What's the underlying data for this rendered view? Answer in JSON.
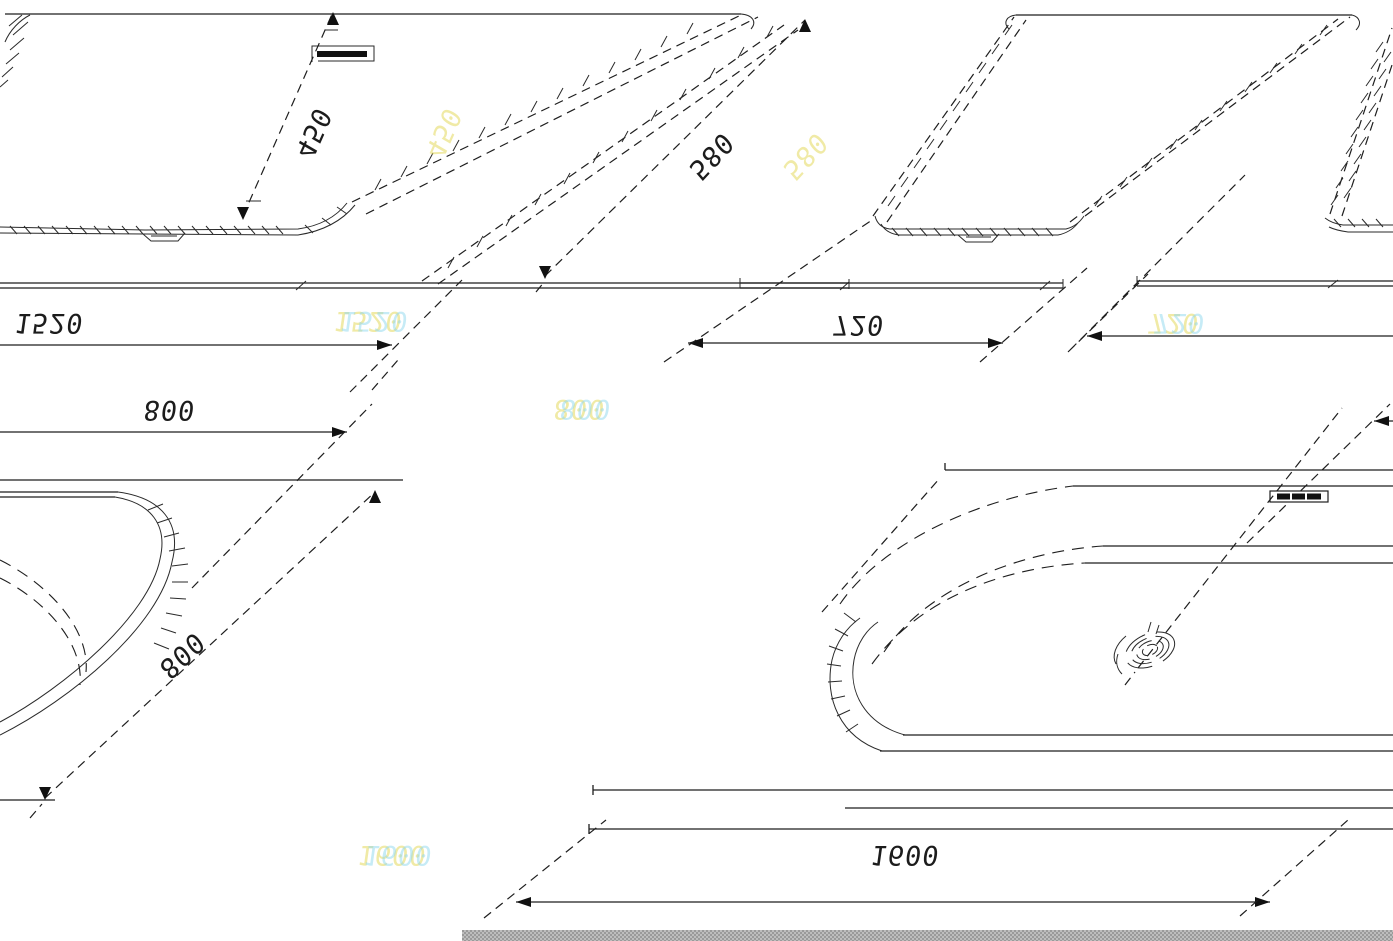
{
  "document": {
    "type": "technical-drawing",
    "subject": "bathtub dimension drawing"
  },
  "dimensions": {
    "side_view_length": "1520",
    "side_view_depth": "450",
    "side_view_height": "580",
    "end_view_width": "720",
    "plan_corner_width": "800",
    "plan_corner_depth": "800",
    "plan_view_length": "1600"
  },
  "ghost_labels": {
    "side_view_length": "1520",
    "end_view_width": "720",
    "plan_corner_width": "800",
    "plan_view_length": "1600",
    "side_view_depth": "450",
    "side_view_height": "580"
  },
  "colors": {
    "ink": "#1e1e1e",
    "ghost_yellow": "#e4da5f",
    "ghost_cyan": "#8fd8ef",
    "strip_gray": "#b0b0b0",
    "background": "#ffffff"
  }
}
